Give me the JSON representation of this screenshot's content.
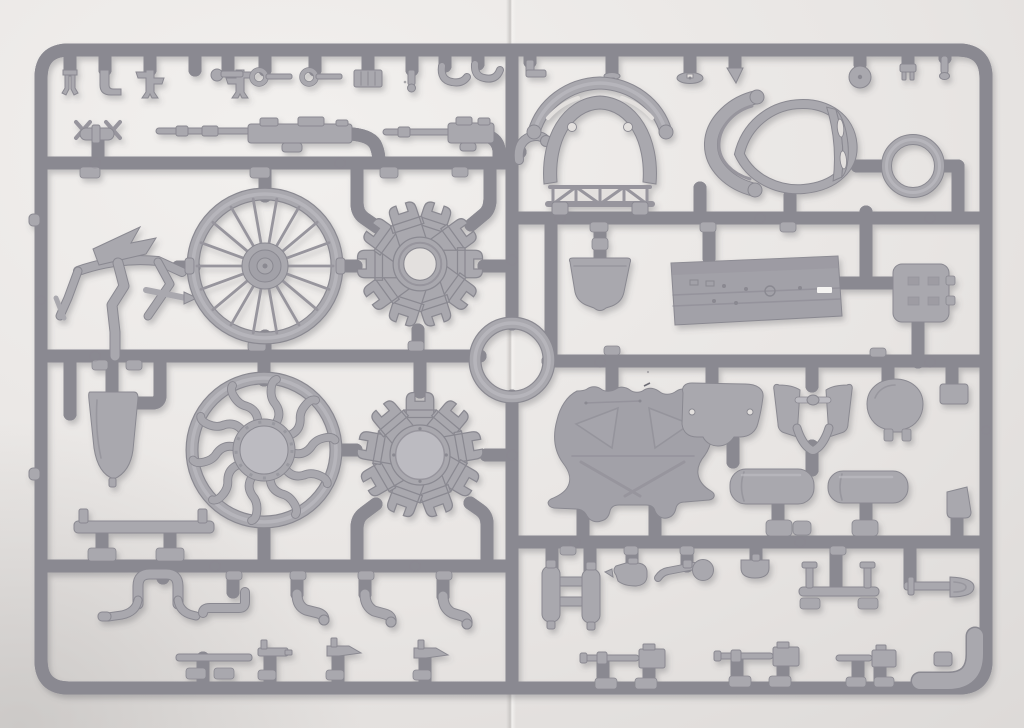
{
  "meta": {
    "description": "Photograph of a light-grey injection-moulded plastic model kit sprue with WWI biplane parts, laid on white paper with a vertical crease in the middle"
  },
  "palette": {
    "paper": "#ebe8e6",
    "paper2": "#e3e0de",
    "paper_lo": "#d3d0ce",
    "seam": "#c8c5c3",
    "plastic": "#a9a8ae",
    "plastic_hi": "#bcbbc1",
    "plastic_dk": "#97959d",
    "plastic_edge": "#8a8991",
    "panel": "#a2a1a8",
    "white_mark": "#f5f4f2",
    "shadow": "#55545c"
  },
  "sprue": {
    "material": "light grey polystyrene",
    "layout": "rounded rectangular frame, two halves joined at a central ring junction",
    "parts": [
      {
        "id": "top-row-fittings-left",
        "half": "left",
        "label": "row of small brackets and fittings"
      },
      {
        "id": "finned-bomb",
        "half": "left",
        "label": "small flare/bomb with cruciform fins"
      },
      {
        "id": "machine-gun-a",
        "half": "left",
        "label": "Vickers machine gun"
      },
      {
        "id": "machine-gun-b",
        "half": "left",
        "label": "Vickers machine gun (second)"
      },
      {
        "id": "elbow-pipe",
        "half": "right",
        "label": "curved intake elbow"
      },
      {
        "id": "tail-skid-frame",
        "half": "left",
        "label": "tail skid / control frame"
      },
      {
        "id": "spoked-wheel",
        "half": "left",
        "label": "wire-spoked wheel"
      },
      {
        "id": "rotary-engine-front",
        "half": "left",
        "label": "rotary engine half, open crankcase"
      },
      {
        "id": "teardrop-tank",
        "half": "left",
        "label": "teardrop auxiliary tank"
      },
      {
        "id": "bent-spoke-wheel",
        "half": "left",
        "label": "wheel with bent pushrod spokes"
      },
      {
        "id": "rotary-engine-rear",
        "half": "left",
        "label": "rotary engine half, closed crankcase"
      },
      {
        "id": "axle-bar",
        "half": "left",
        "label": "axle bar with posts"
      },
      {
        "id": "cabane-arch",
        "half": "left",
        "label": "arched strut with curved feet"
      },
      {
        "id": "exhaust-pipes",
        "half": "left",
        "label": "bent exhaust pipes (x4)"
      },
      {
        "id": "control-levers",
        "half": "left",
        "label": "control levers and quadrant (x4)"
      },
      {
        "id": "center-ring",
        "half": "center",
        "label": "central ring junction"
      },
      {
        "id": "top-row-fittings-right",
        "half": "right",
        "label": "pins, disc and small fittings"
      },
      {
        "id": "cowl-hoop-truss",
        "half": "right",
        "label": "cowling hoop with trussed former"
      },
      {
        "id": "cowl-ring-egg",
        "half": "right",
        "label": "egg-shaped cowling ring"
      },
      {
        "id": "v-brace",
        "half": "right",
        "label": "V-shaped windscreen brace"
      },
      {
        "id": "cowl-ring-small",
        "half": "right",
        "label": "small cowling ring"
      },
      {
        "id": "seat-bucket",
        "half": "right",
        "label": "seat back bucket"
      },
      {
        "id": "floor-panel",
        "half": "right",
        "label": "cockpit floor panel"
      },
      {
        "id": "ammo-box",
        "half": "right",
        "label": "ammunition box"
      },
      {
        "id": "firewall-bell",
        "half": "right",
        "label": "bell-shaped firewall former with X ridges"
      },
      {
        "id": "instrument-blank",
        "half": "right",
        "label": "instrument panel blank with two holes"
      },
      {
        "id": "engine-yoke",
        "half": "right",
        "label": "engine mount yoke with pin"
      },
      {
        "id": "round-cover",
        "half": "right",
        "label": "round access cover"
      },
      {
        "id": "stowage-box-1",
        "half": "right",
        "label": "small stowage box"
      },
      {
        "id": "stowage-box-2",
        "half": "right",
        "label": "small stowage box (angled)"
      },
      {
        "id": "fuel-tank-1",
        "half": "right",
        "label": "cylindrical fuel tank"
      },
      {
        "id": "fuel-tank-2",
        "half": "right",
        "label": "cylindrical fuel tank (second)"
      },
      {
        "id": "twin-bottles",
        "half": "right",
        "label": "twin oil bottles with crossbars"
      },
      {
        "id": "oil-can",
        "half": "right",
        "label": "oil can with spout"
      },
      {
        "id": "hand-pump",
        "half": "right",
        "label": "hand pump with ball grip"
      },
      {
        "id": "bowl-cover",
        "half": "right",
        "label": "small bowl cover"
      },
      {
        "id": "stand-axle",
        "half": "right",
        "label": "axle with stand-off pins"
      },
      {
        "id": "shovel",
        "half": "right",
        "label": "entrenching shovel"
      },
      {
        "id": "machine-gun-c",
        "half": "right",
        "label": "machine gun (bottom row)"
      },
      {
        "id": "machine-gun-d",
        "half": "right",
        "label": "machine gun (bottom row)"
      },
      {
        "id": "machine-gun-e",
        "half": "right",
        "label": "machine gun, short (bottom row)"
      },
      {
        "id": "corner-gusset",
        "half": "right",
        "label": "thickened corner gusset"
      }
    ]
  }
}
